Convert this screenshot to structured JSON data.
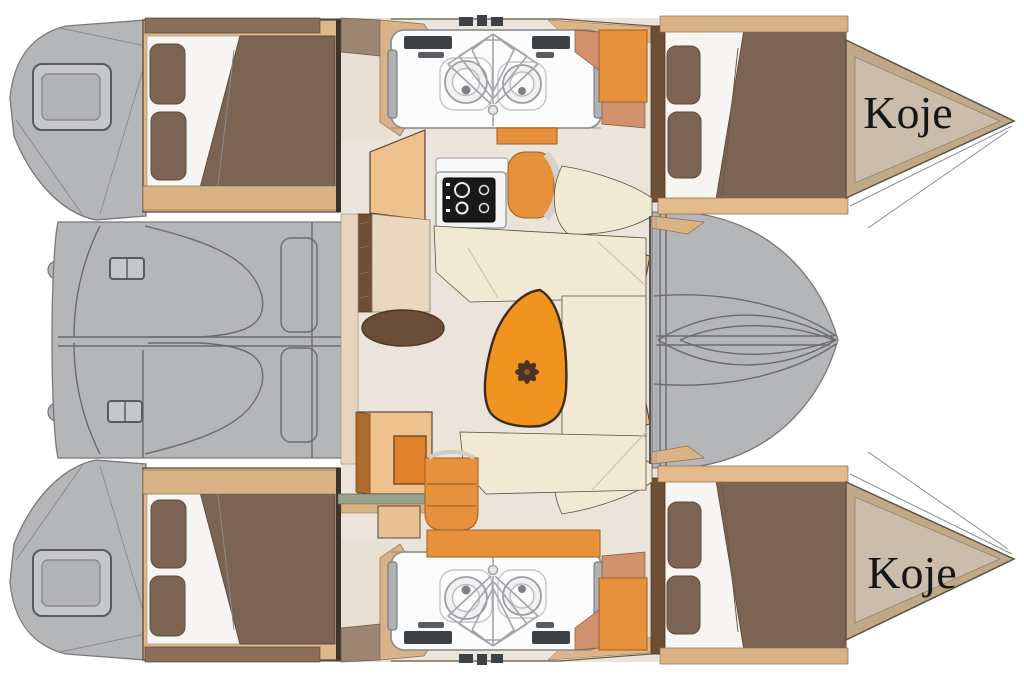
{
  "page": {
    "background": "#ffffff"
  },
  "labels": {
    "koje_port": "Koje",
    "koje_starboard": "Koje"
  },
  "colors": {
    "background": "#ffffff",
    "deck_gray": "#b5b6b8",
    "bed_brown": "#7b6453",
    "wood_tan": "#d9b286",
    "wood_dark": "#8b6f5b",
    "bow_beige": "#cbbcab",
    "bow_trim": "#bfa987",
    "floor_beige": "#eae4db",
    "cream": "#f2e9d4",
    "orange": "#e8913c",
    "orange_dark": "#e0832c",
    "table_orange": "#f0941f",
    "tan_light": "#eec18f",
    "counter_beige": "#e9d7bf",
    "door_brown": "#6e4f35",
    "stove_black": "#191919",
    "console_white": "#fcfcfc",
    "console_bar": "#3d4247",
    "green_bar": "#97a28f",
    "text": "#161616"
  }
}
